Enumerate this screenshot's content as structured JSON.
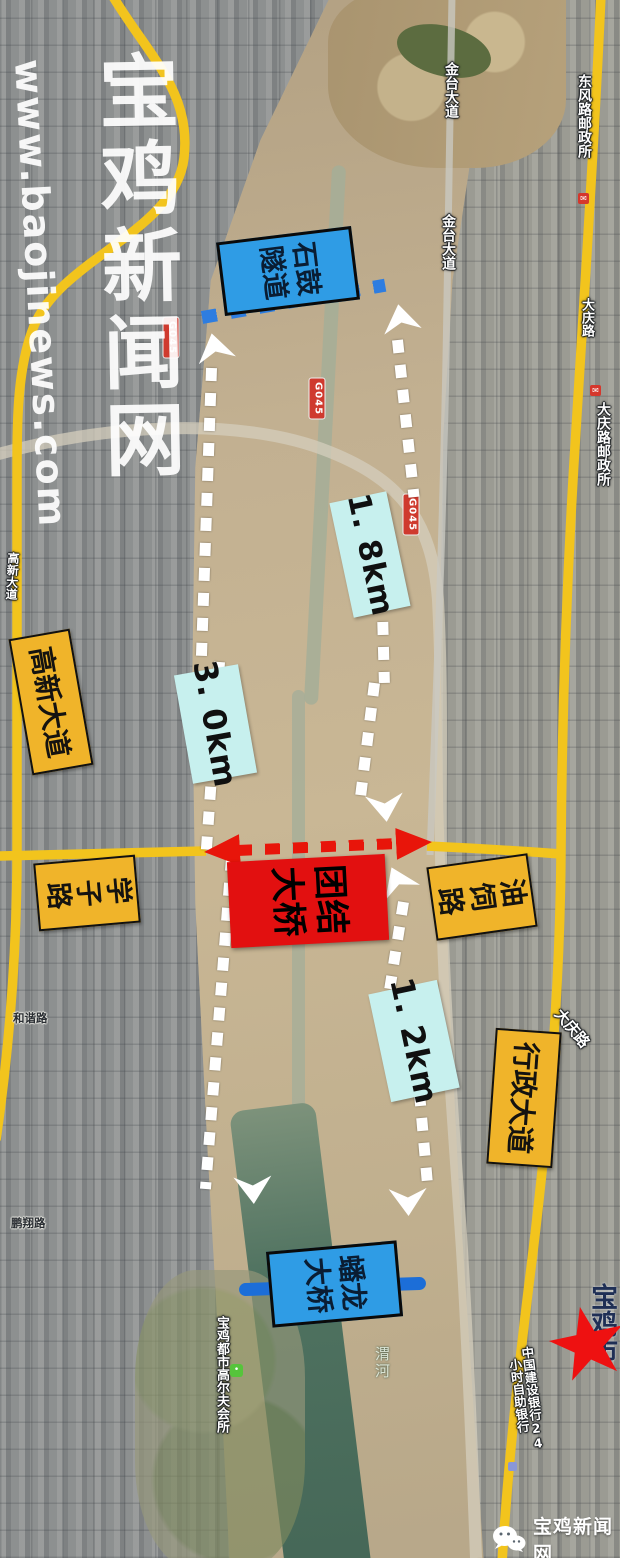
{
  "watermark": {
    "site": "宝鸡新闻网",
    "url": "www.baojinews.com"
  },
  "annotations": {
    "tunnel_label": "石鼓隧道",
    "tuanjie_bridge_label": "团结大桥",
    "panlong_bridge_label": "蟠龙大桥",
    "distance_top": "1. 8km",
    "distance_left": "3. 0km",
    "distance_bottom": "1. 2km",
    "gaoxin_avenue": "高新大道",
    "xuezi_road": "学子路",
    "yousi_road": "油饲路",
    "xingzheng_avenue": "行政大道"
  },
  "base_map": {
    "jintai_avenue": "金台大道",
    "dongfeng_post_office": "东风路邮政所",
    "daqing_road": "大庆路",
    "daqing_post_office": "大庆路邮政所",
    "highway_shield": "G045",
    "wei_river": "渭河",
    "golf_club": "宝鸡都市高尔夫会所",
    "bank_label_col1": "中国建设银行24",
    "bank_label_col2": "小时自助银行",
    "city_label": "宝鸡市",
    "small_road_west_1": "和谐路",
    "small_road_west_2": "鹏翔路",
    "gaoxin_road_small": "高新大道"
  },
  "branding": {
    "logo_text": "宝鸡新闻网"
  },
  "colors": {
    "road_yellow": "#f2c41d",
    "label_box_yellow": "#f0b42a",
    "distance_box_cyan": "#c7f0ee",
    "tunnel_box_blue": "#2f9ce5",
    "bridge_box_red": "#e21010",
    "bridge_arrow_red": "#e8150a",
    "tunnel_dash_blue": "#2e7de0",
    "panlong_bar_blue": "#1c6ed8",
    "star_red": "#ee1111",
    "route_dot_white": "#ffffff"
  }
}
